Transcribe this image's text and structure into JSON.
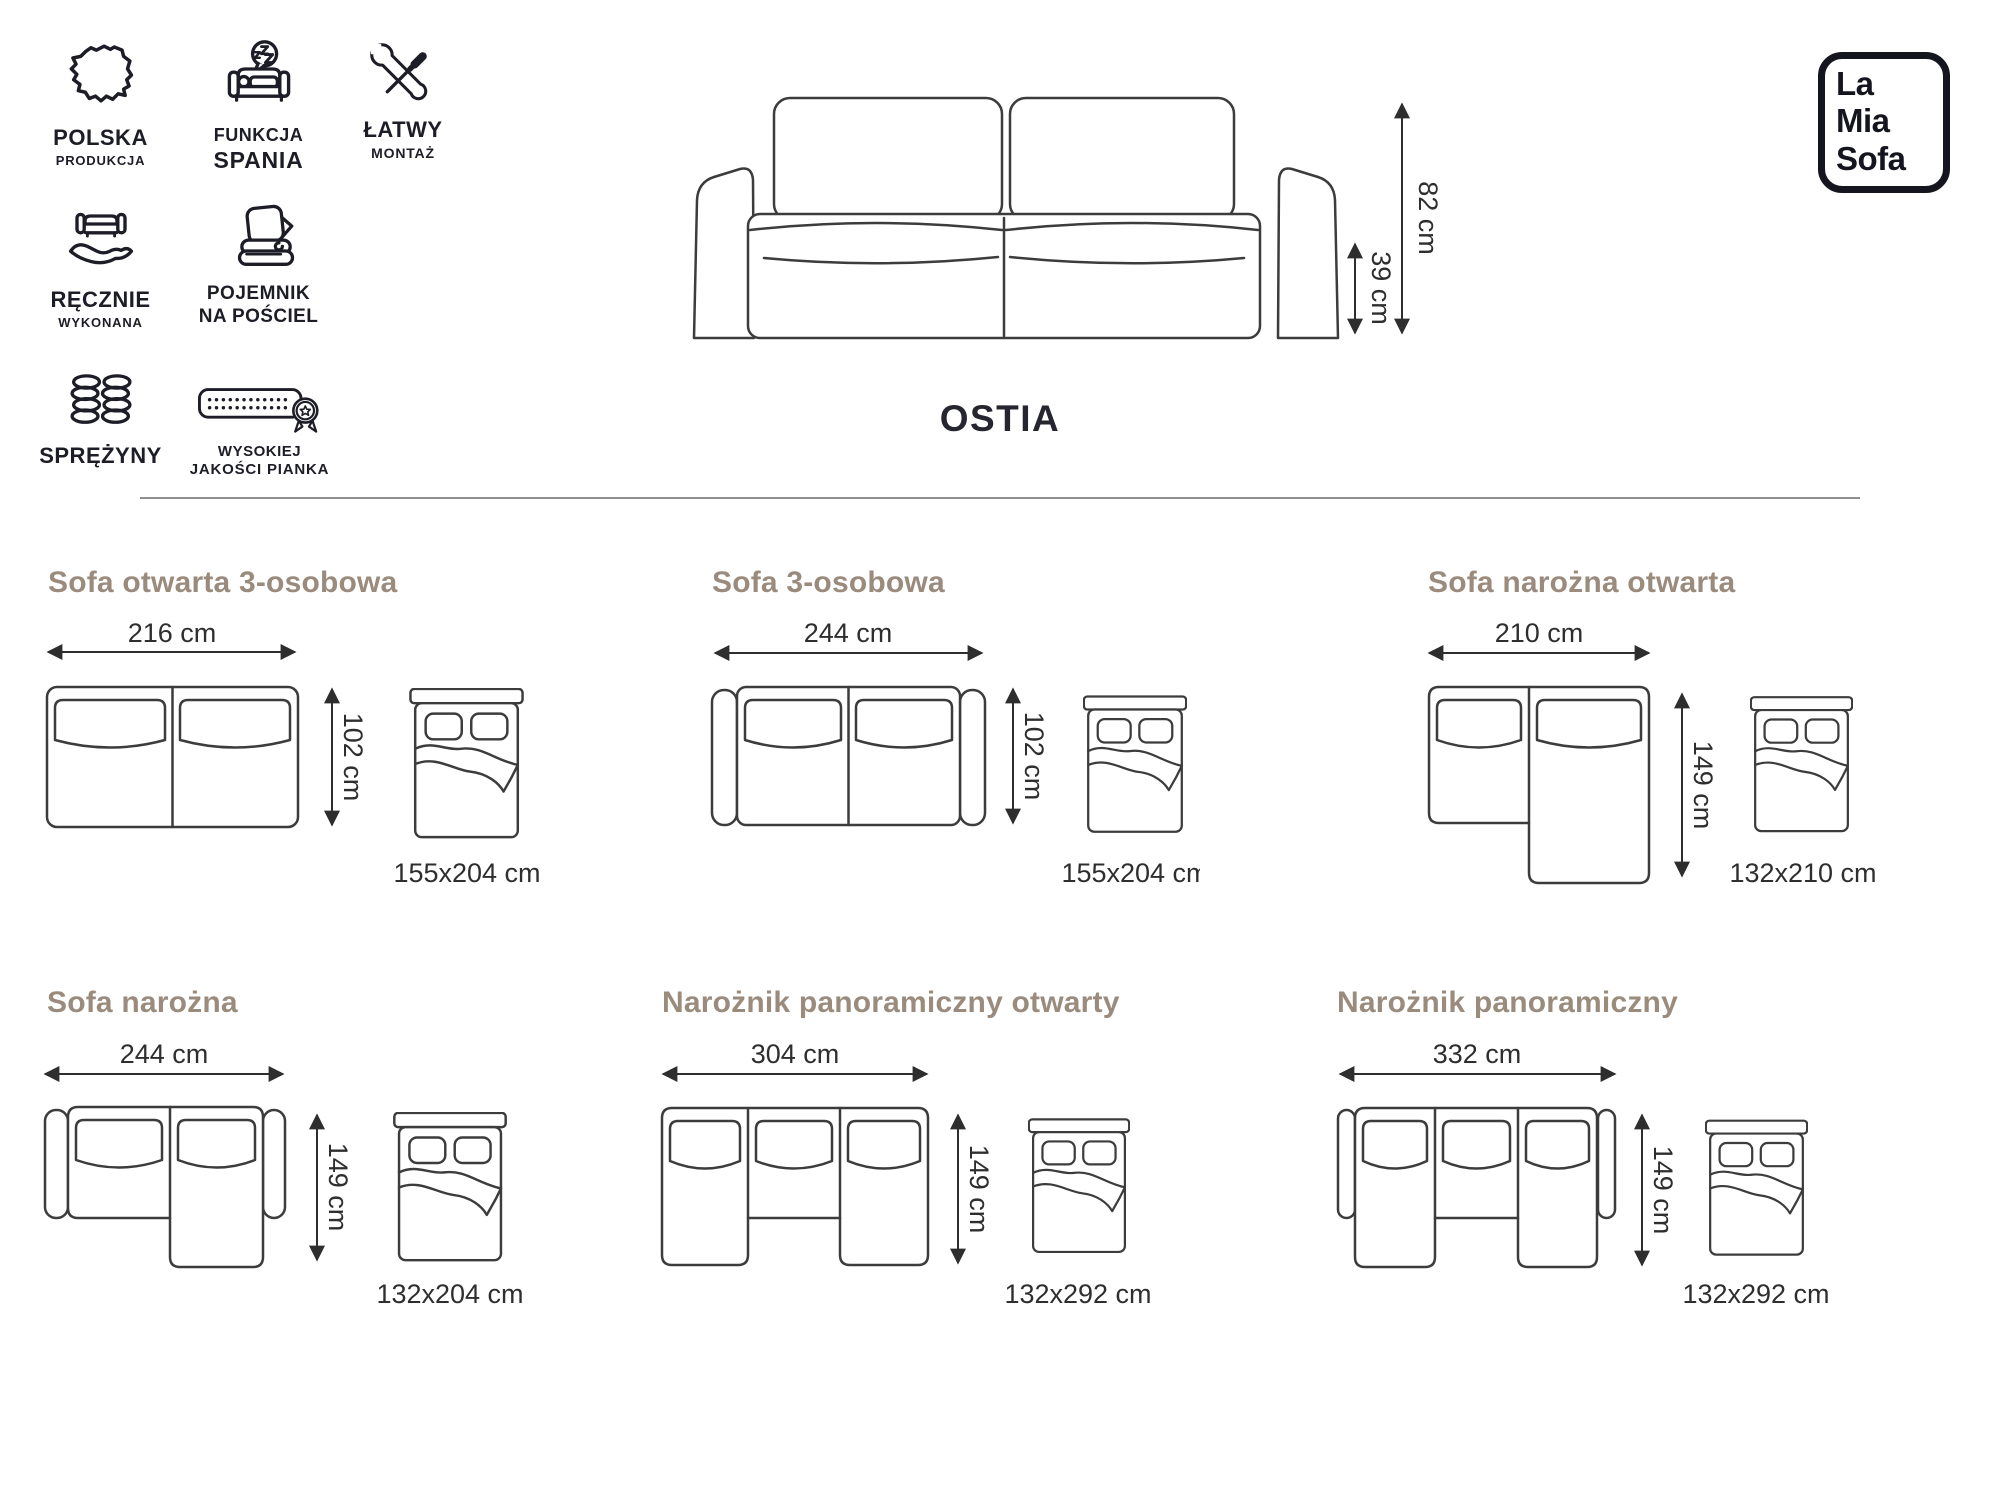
{
  "page": {
    "title": "OSTIA"
  },
  "brand": {
    "line1": "La",
    "line2": "Mia",
    "line3": "Sofa"
  },
  "badges": [
    {
      "icon": "poland-map-icon",
      "lines": [
        "POLSKA",
        "PRODUKCJA"
      ]
    },
    {
      "icon": "sleep-function-icon",
      "lines": [
        "FUNKCJA",
        "SPANIA"
      ]
    },
    {
      "icon": "easy-assembly-icon",
      "lines": [
        "ŁATWY",
        "MONTAŻ"
      ]
    },
    {
      "icon": "handmade-icon",
      "lines": [
        "RĘCZNIE",
        "WYKONANA"
      ]
    },
    {
      "icon": "bedding-storage-icon",
      "lines": [
        "POJEMNIK",
        "NA POŚCIEL"
      ]
    },
    {
      "icon": "springs-icon",
      "lines": [
        "SPRĘŻYNY"
      ]
    },
    {
      "icon": "foam-quality-icon",
      "lines": [
        "WYSOKIEJ",
        "JAKOŚCI PIANKA"
      ]
    }
  ],
  "main_sofa": {
    "height_label": "82 cm",
    "seat_height_label": "39 cm"
  },
  "variants": [
    {
      "title": "Sofa otwarta 3-osobowa",
      "width": "216 cm",
      "depth": "102 cm",
      "bed": "155x204 cm"
    },
    {
      "title": "Sofa 3-osobowa",
      "width": "244 cm",
      "depth": "102 cm",
      "bed": "155x204 cm"
    },
    {
      "title": "Sofa narożna otwarta",
      "width": "210 cm",
      "depth": "149 cm",
      "bed": "132x210 cm"
    },
    {
      "title": "Sofa narożna",
      "width": "244 cm",
      "depth": "149 cm",
      "bed": "132x204 cm"
    },
    {
      "title": "Narożnik panoramiczny otwarty",
      "width": "304 cm",
      "depth": "149 cm",
      "bed": "132x292 cm"
    },
    {
      "title": "Narożnik panoramiczny",
      "width": "332 cm",
      "depth": "149 cm",
      "bed": "132x292 cm"
    }
  ],
  "colors": {
    "heading": "#9a8b7d",
    "line": "#3c3c3c",
    "text": "#2e2e2e",
    "logo": "#15151f"
  }
}
